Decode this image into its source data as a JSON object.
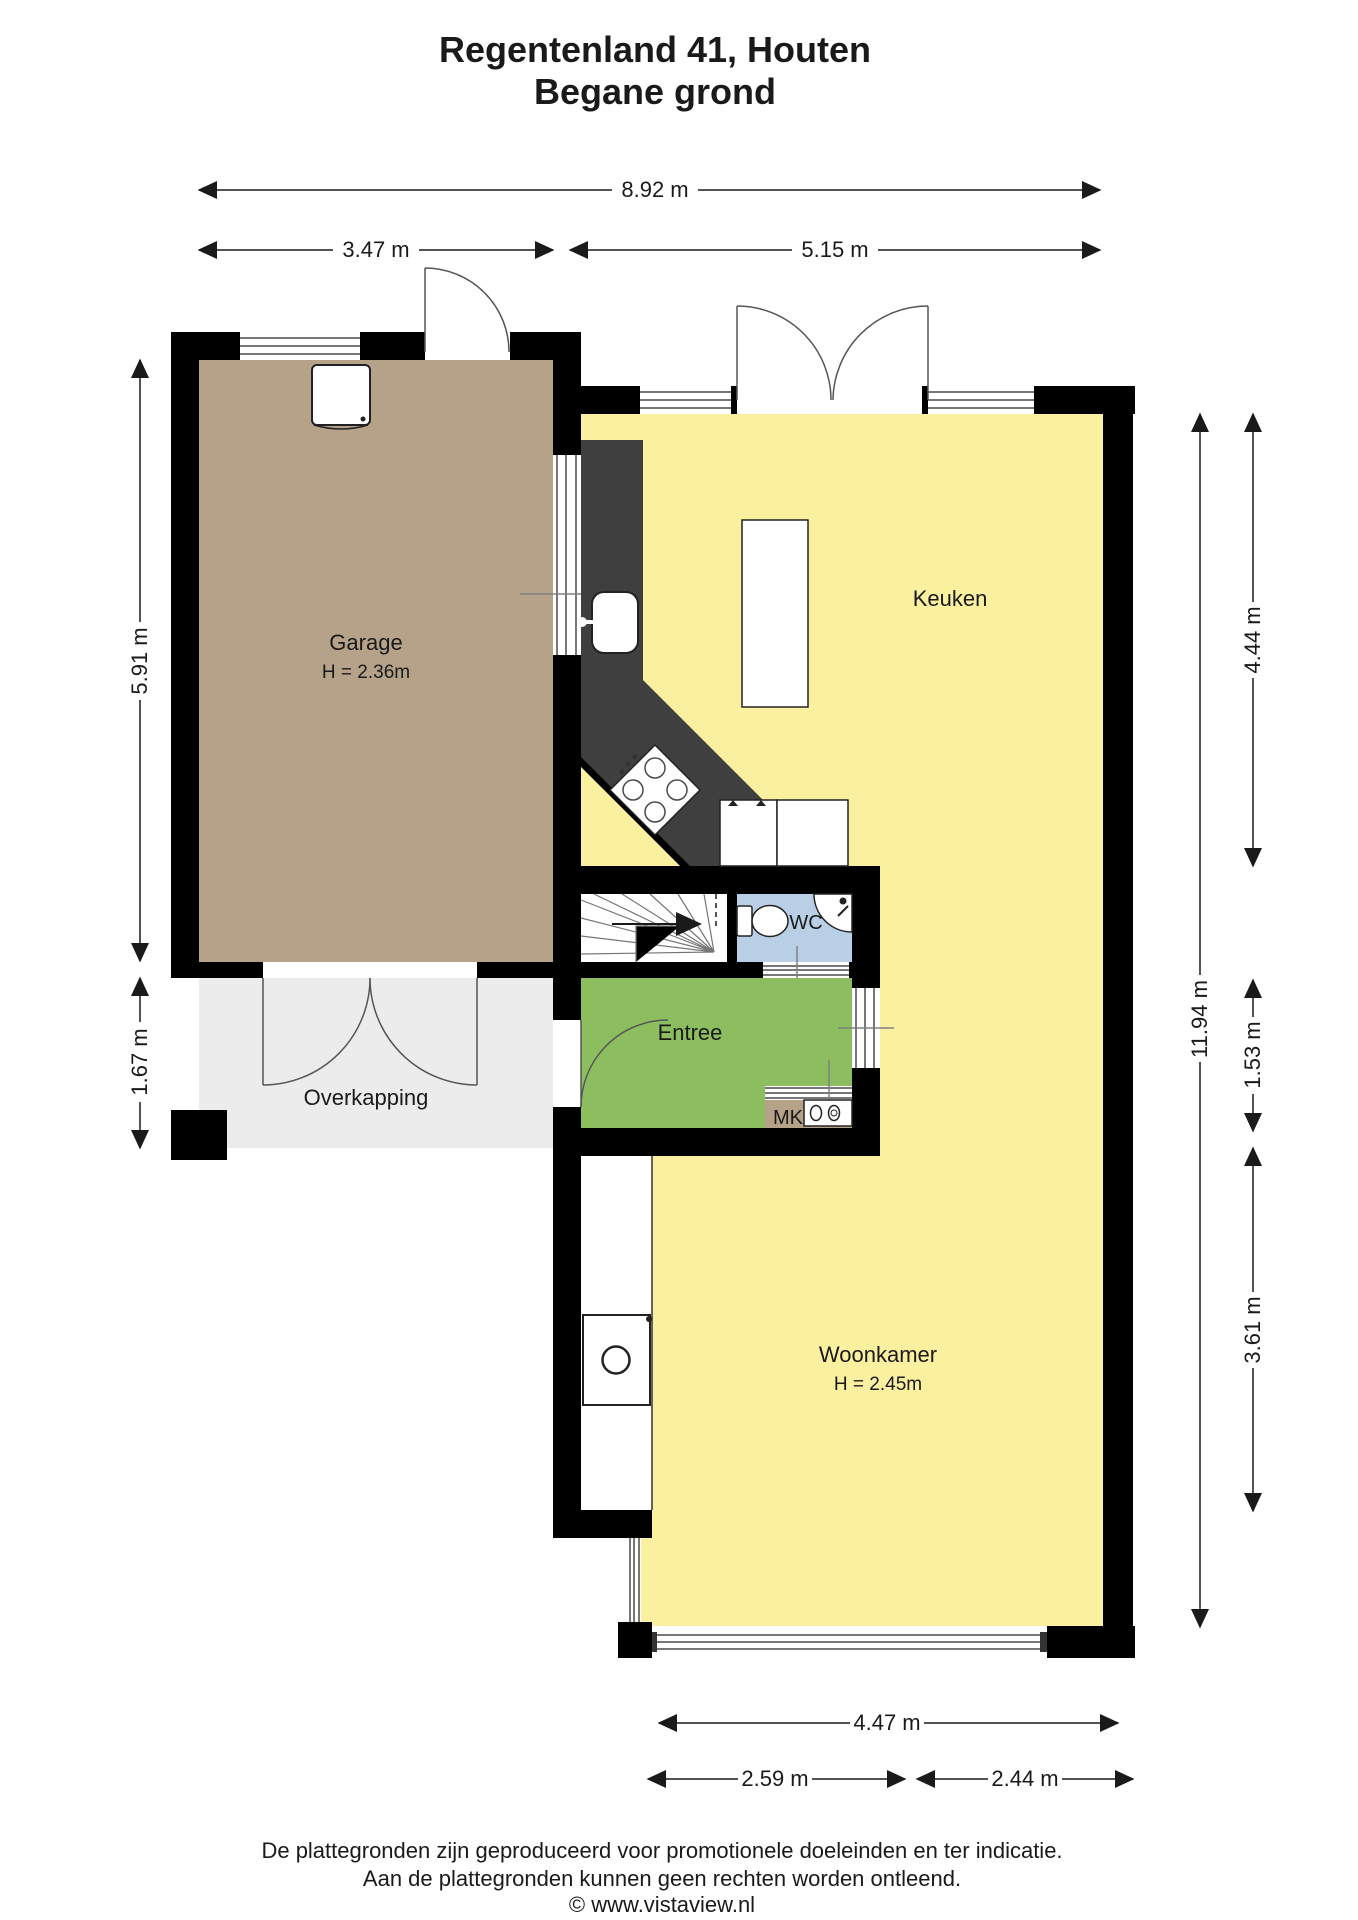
{
  "title": {
    "line1": "Regentenland 41, Houten",
    "line2": "Begane grond"
  },
  "rooms": {
    "garage": {
      "label": "Garage",
      "height": "H = 2.36m"
    },
    "keuken": {
      "label": "Keuken"
    },
    "wc": {
      "label": "WC"
    },
    "entree": {
      "label": "Entree"
    },
    "overkapping": {
      "label": "Overkapping"
    },
    "woonkamer": {
      "label": "Woonkamer",
      "height": "H = 2.45m"
    },
    "mk": {
      "label": "MK"
    }
  },
  "dimensions": {
    "top_total": "8.92 m",
    "top_left": "3.47 m",
    "top_right": "5.15 m",
    "left_garage": "5.91 m",
    "left_overkapping": "1.67 m",
    "right_total": "11.94 m",
    "right_kitchen": "4.44 m",
    "right_entree": "1.53 m",
    "right_woonkamer": "3.61 m",
    "bottom_total": "4.47 m",
    "bottom_left": "2.59 m",
    "bottom_right": "2.44 m"
  },
  "footer": {
    "line1": "De plattegronden zijn geproduceerd voor promotionele doeleinden en ter indicatie.",
    "line2": "Aan de plattegronden kunnen geen rechten worden ontleend.",
    "line3": "© www.vistaview.nl"
  },
  "colors": {
    "floor_yellow": "#FAF0A0",
    "floor_garage": "#B5A289",
    "floor_entree": "#8CBE60",
    "floor_wc": "#B9CFE6",
    "floor_overkapping": "#ECECEC",
    "floor_mk": "#B5A289",
    "counter_dark": "#3F3F3F",
    "wall_black": "#000000"
  }
}
